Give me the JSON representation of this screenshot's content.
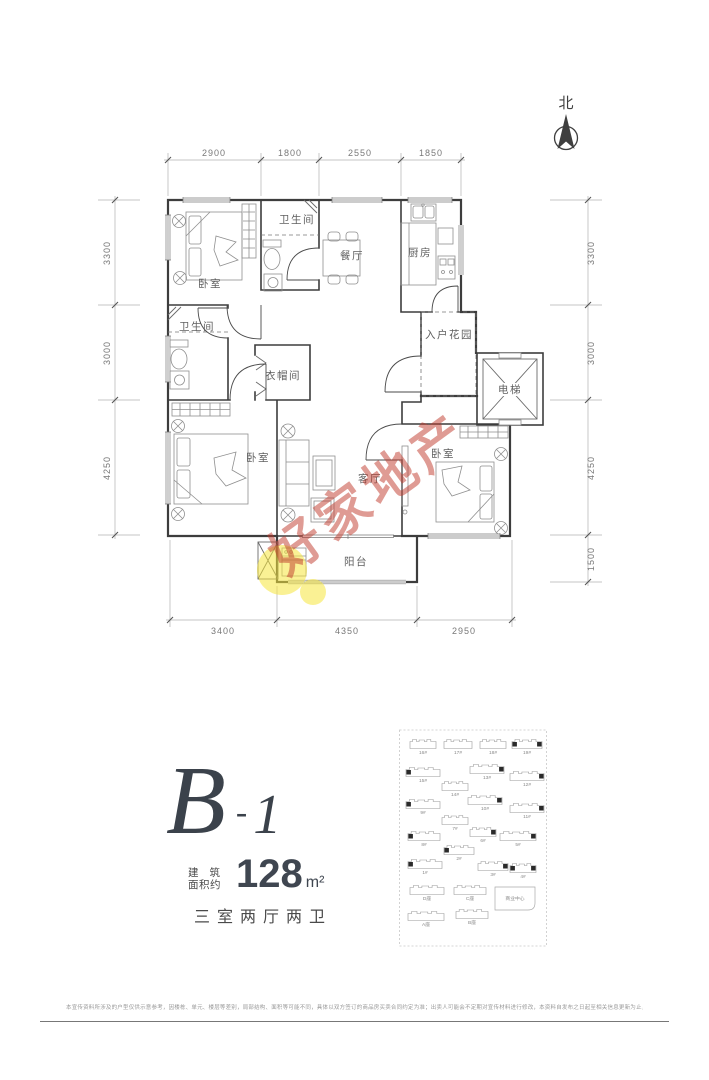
{
  "north": {
    "label": "北"
  },
  "floor_plan": {
    "rooms": {
      "bedroom1": "卧室",
      "bath1": "卫生间",
      "dining": "餐厅",
      "kitchen": "厨房",
      "bath2": "卫生间",
      "cloakroom": "衣帽间",
      "garden": "入户花园",
      "elevator": "电梯",
      "bedroom2": "卧室",
      "living": "客厅",
      "bedroom3": "卧室",
      "balcony": "阳台"
    },
    "dims": {
      "top": [
        "2900",
        "1800",
        "2550",
        "1850"
      ],
      "left": [
        "3300",
        "3000",
        "4250"
      ],
      "right": [
        "3300",
        "3000",
        "4250",
        "1500"
      ],
      "bottom": [
        "3400",
        "4350",
        "2950"
      ]
    }
  },
  "watermark": {
    "text": "好家地产",
    "accent_red": "#c0392b",
    "accent_yellow": "#f5e63c"
  },
  "unit": {
    "code_letter": "B",
    "code_dash": "-",
    "code_number": "1",
    "area_label_line1": "建筑",
    "area_label_line2": "面积约",
    "area_value": "128",
    "area_unit": "m²",
    "layout_text": "三室两厅两卫"
  },
  "site_plan": {
    "center_label": "商业中心",
    "buildings": [
      {
        "label": "16#",
        "x": 12,
        "y": 12,
        "w": 26,
        "mark": ""
      },
      {
        "label": "17#",
        "x": 46,
        "y": 12,
        "w": 28,
        "mark": ""
      },
      {
        "label": "18#",
        "x": 82,
        "y": 12,
        "w": 26,
        "mark": ""
      },
      {
        "label": "19#",
        "x": 114,
        "y": 12,
        "w": 30,
        "mark": "LR"
      },
      {
        "label": "15#",
        "x": 8,
        "y": 40,
        "w": 34,
        "mark": "L"
      },
      {
        "label": "13#",
        "x": 72,
        "y": 37,
        "w": 34,
        "mark": "R"
      },
      {
        "label": "12#",
        "x": 112,
        "y": 44,
        "w": 34,
        "mark": "R"
      },
      {
        "label": "14#",
        "x": 44,
        "y": 54,
        "w": 26,
        "mark": ""
      },
      {
        "label": "9#",
        "x": 8,
        "y": 72,
        "w": 34,
        "mark": "L"
      },
      {
        "label": "10#",
        "x": 70,
        "y": 68,
        "w": 34,
        "mark": "R"
      },
      {
        "label": "11#",
        "x": 112,
        "y": 76,
        "w": 34,
        "mark": "R"
      },
      {
        "label": "7#",
        "x": 44,
        "y": 88,
        "w": 26,
        "mark": ""
      },
      {
        "label": "8#",
        "x": 10,
        "y": 104,
        "w": 32,
        "mark": "L"
      },
      {
        "label": "6#",
        "x": 72,
        "y": 100,
        "w": 26,
        "mark": "R"
      },
      {
        "label": "5#",
        "x": 102,
        "y": 104,
        "w": 36,
        "mark": "R"
      },
      {
        "label": "2#",
        "x": 46,
        "y": 118,
        "w": 30,
        "mark": "L"
      },
      {
        "label": "1#",
        "x": 10,
        "y": 132,
        "w": 34,
        "mark": "L"
      },
      {
        "label": "3#",
        "x": 80,
        "y": 134,
        "w": 30,
        "mark": "R"
      },
      {
        "label": "4#",
        "x": 112,
        "y": 136,
        "w": 26,
        "mark": "LR"
      },
      {
        "label": "D座",
        "x": 12,
        "y": 158,
        "w": 34,
        "mark": ""
      },
      {
        "label": "C座",
        "x": 56,
        "y": 158,
        "w": 32,
        "mark": ""
      },
      {
        "label": "A座",
        "x": 10,
        "y": 184,
        "w": 36,
        "mark": ""
      },
      {
        "label": "B座",
        "x": 58,
        "y": 182,
        "w": 32,
        "mark": ""
      }
    ]
  },
  "footer": {
    "disclaimer": "本宣传资料所涉及的户型仅供示意参考，因楼栋、单元、楼层等差别，局部结构、面积等可能不同，具体以双方签订的商品房买卖合同约定为准；出卖人可能会不定期对宣传材料进行修改，本资料自发布之日起至相关信息更新为止，不代表出卖人对此作出的承诺。"
  }
}
